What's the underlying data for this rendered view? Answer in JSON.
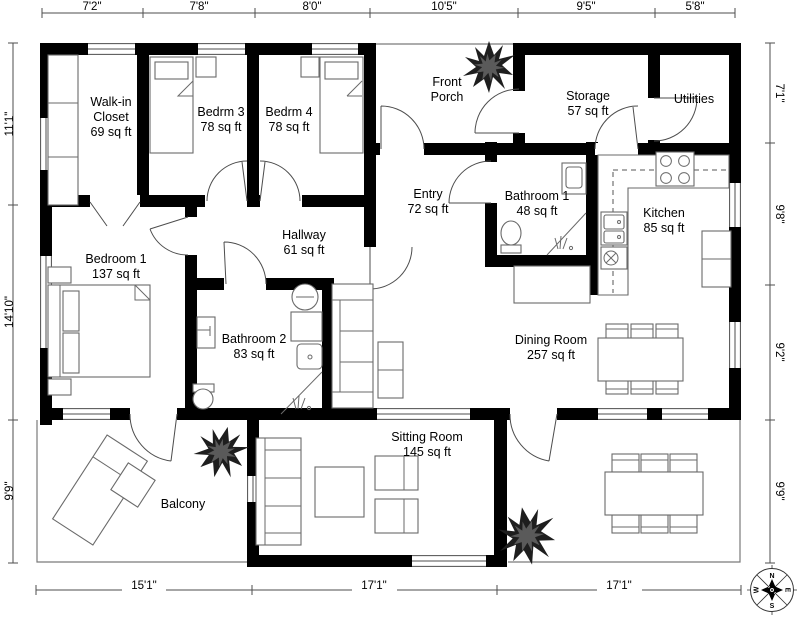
{
  "plan_title": "floor-plan",
  "rooms": {
    "walk_in_closet": {
      "lines": [
        "Walk-in",
        "Closet",
        "69 sq ft"
      ]
    },
    "bedrm3": {
      "lines": [
        "Bedrm 3",
        "78 sq ft"
      ]
    },
    "bedrm4": {
      "lines": [
        "Bedrm 4",
        "78 sq ft"
      ]
    },
    "front_porch": {
      "lines": [
        "Front",
        "Porch"
      ]
    },
    "storage": {
      "lines": [
        "Storage",
        "57 sq ft"
      ]
    },
    "utilities": {
      "lines": [
        "Utilities"
      ]
    },
    "entry": {
      "lines": [
        "Entry",
        "72 sq ft"
      ]
    },
    "bathroom1": {
      "lines": [
        "Bathroom 1",
        "48 sq ft"
      ]
    },
    "kitchen": {
      "lines": [
        "Kitchen",
        "85 sq ft"
      ]
    },
    "bedroom1": {
      "lines": [
        "Bedroom 1",
        "137 sq ft"
      ]
    },
    "hallway": {
      "lines": [
        "Hallway",
        "61 sq ft"
      ]
    },
    "bathroom2": {
      "lines": [
        "Bathroom 2",
        "83 sq ft"
      ]
    },
    "dining_room": {
      "lines": [
        "Dining Room",
        "257 sq ft"
      ]
    },
    "sitting_room": {
      "lines": [
        "Sitting Room",
        "145 sq ft"
      ]
    },
    "balcony": {
      "lines": [
        "Balcony"
      ]
    }
  },
  "dimensions": {
    "top": [
      "7'2\"",
      "7'8\"",
      "8'0\"",
      "10'5\"",
      "9'5\"",
      "5'8\""
    ],
    "left": [
      "11'1\"",
      "14'10\"",
      "9'9\""
    ],
    "right": [
      "7'1\"",
      "9'8\"",
      "9'2\"",
      "9'9\""
    ],
    "bottom": [
      "15'1\"",
      "17'1\"",
      "17'1\""
    ]
  },
  "compass": {
    "n": "N",
    "e": "E",
    "s": "S",
    "w": "W"
  },
  "colors": {
    "wall": "#000000",
    "line": "#4d4d4d",
    "text": "#000000"
  }
}
